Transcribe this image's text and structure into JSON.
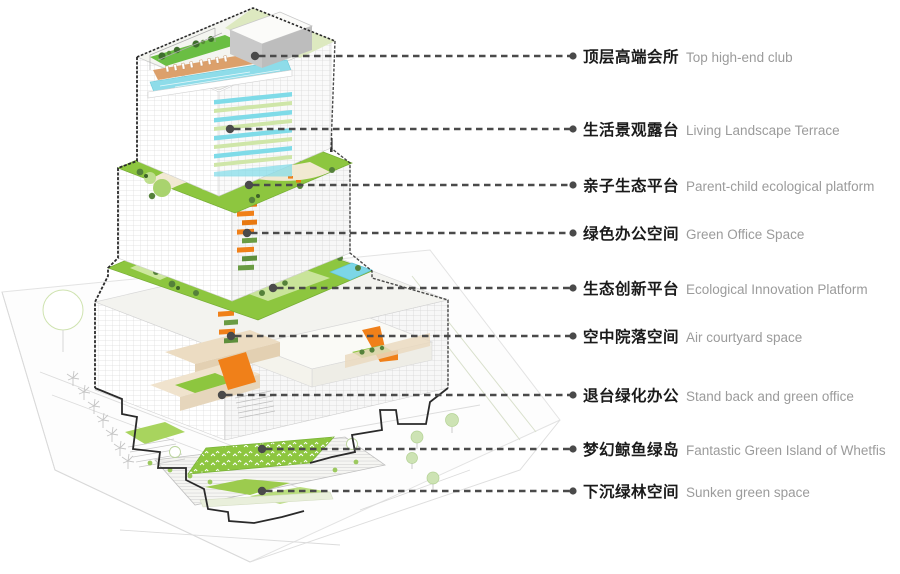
{
  "figure": {
    "type": "architectural-axonometric-program-diagram",
    "subject": "Stacked green-terrace office tower with program level callouts"
  },
  "callouts": [
    {
      "zh": "顶层高端会所",
      "en": "Top high-end club"
    },
    {
      "zh": "生活景观露台",
      "en": "Living Landscape Terrace"
    },
    {
      "zh": "亲子生态平台",
      "en": "Parent-child ecological platform"
    },
    {
      "zh": "绿色办公空间",
      "en": "Green Office Space"
    },
    {
      "zh": "生态创新平台",
      "en": "Ecological Innovation Platform"
    },
    {
      "zh": "空中院落空间",
      "en": "Air courtyard space"
    },
    {
      "zh": "退台绿化办公",
      "en": "Stand back and green office"
    },
    {
      "zh": "梦幻鲸鱼绿岛",
      "en": "Fantastic Green Island of Whetfis"
    },
    {
      "zh": "下沉绿林空间",
      "en": "Sunken green space"
    }
  ],
  "colors": {
    "terrace_green": "#8dc63f",
    "lawn_light": "#c9e49a",
    "pale_pavilion": "#e9efc3",
    "pool_cyan": "#7fdbe8",
    "stripe_green": "#cfe6a8",
    "accent_orange": "#f08019",
    "deck_tan": "#dca06b",
    "beige_wall": "#ecdcc2",
    "callout_line": "#4a4a4a",
    "zh_text": "#1a1a1a",
    "en_text": "#9b9b9b"
  }
}
